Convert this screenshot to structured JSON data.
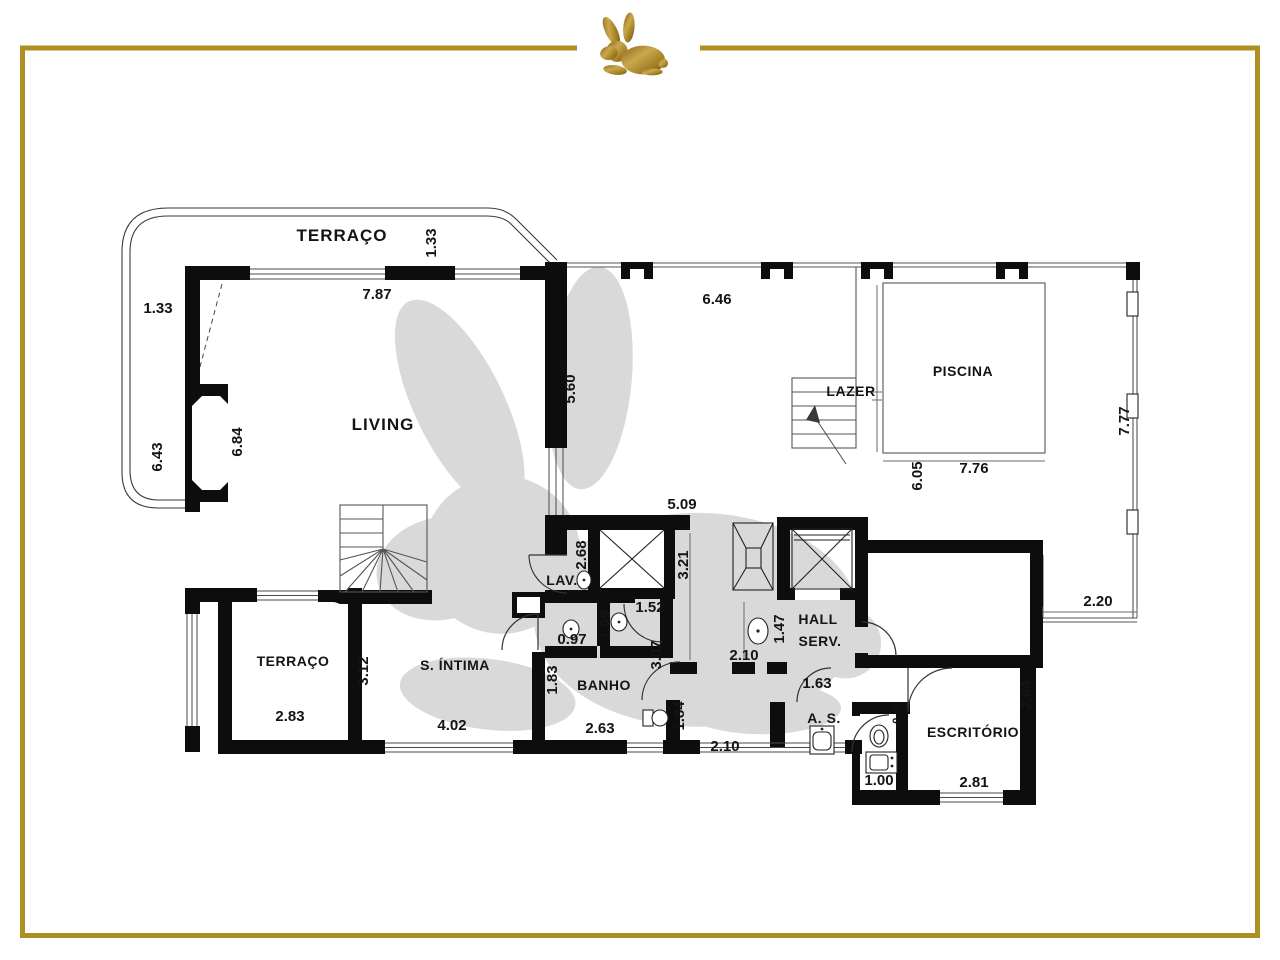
{
  "branding": {
    "logo_icon": "rabbit-logo",
    "watermark_icon": "rabbit-watermark",
    "frame_color": "#ac8f25",
    "logo_gold_dark": "#7a5a14",
    "logo_gold_light": "#c9a84e",
    "watermark_color": "#d9d9d9",
    "wall_color": "#0d0d0d"
  },
  "plan": {
    "labels": {
      "terrace_top": "TERRAÇO",
      "living": "LIVING",
      "piscina": "PISCINA",
      "lazer": "LAZER",
      "lav": "LAV.",
      "banho": "BANHO",
      "s_intima": "S. ÍNTIMA",
      "terrace_bottom": "TERRAÇO",
      "hall_line1": "HALL",
      "hall_line2": "SERV.",
      "as": "A. S.",
      "escritorio": "ESCRITÓRIO"
    },
    "dims": {
      "terrace_top_depth": "1.33",
      "living_top_width": "7.87",
      "terrace_left_depth": "1.33",
      "outer_left_height": "6.43",
      "living_left_height": "6.84",
      "living_right_height": "5.60",
      "deck_top_width": "6.46",
      "deck_right_height": "7.77",
      "pool_width": "7.76",
      "pool_height": "6.05",
      "deck_bottom_width": "2.20",
      "hall_top_width": "5.09",
      "lav_height": "2.68",
      "hall_left_height": "3.21",
      "wc_width": "1.52",
      "wc_height": "1.09",
      "wc2_width": "0.97",
      "banho_left_height": "1.83",
      "corridor_height": "3.07",
      "banho_width": "2.63",
      "corridor2_height": "1.84",
      "corridor_bottom_width": "2.10",
      "hall_width": "2.10",
      "hall_serv_height": "1.47",
      "as_door_offset": "1.63",
      "terrace2_width": "2.83",
      "terrace2_divider_height": "3.12",
      "s_intima_width": "4.02",
      "escritorio_height": "2.64",
      "escritorio_width": "2.81",
      "bath_width": "1.00",
      "bath_depth": "0.74"
    }
  }
}
